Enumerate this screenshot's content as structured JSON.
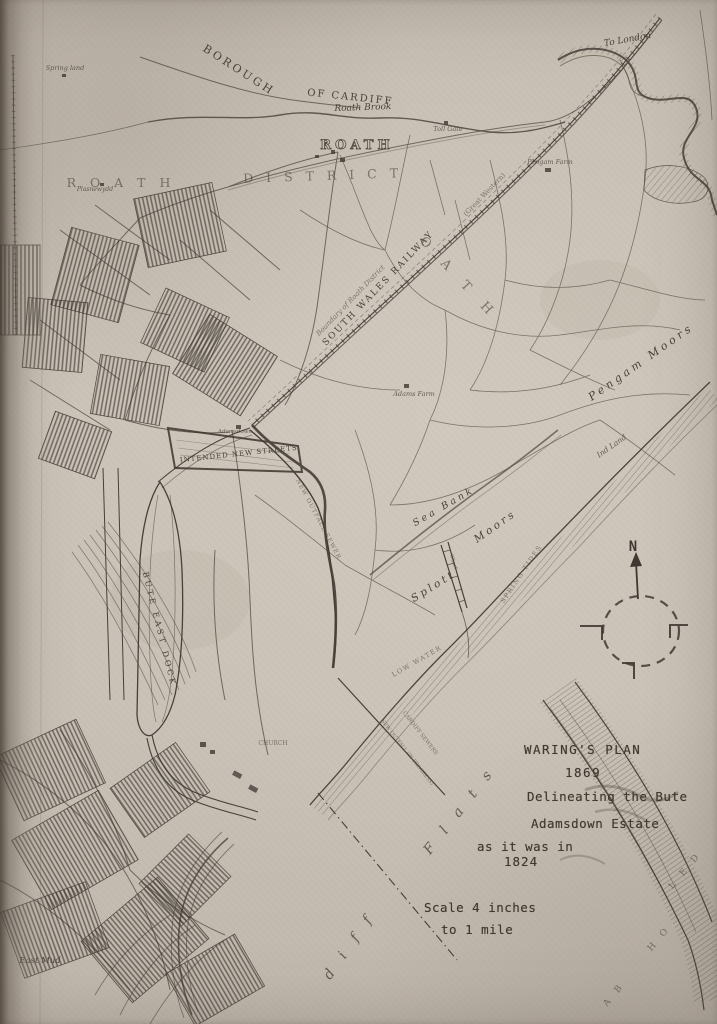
{
  "colors": {
    "paper": "#c9c0b5",
    "ink": "#4a433b",
    "gutter_shadow": "#6f665c"
  },
  "annotation": {
    "title_lines": [
      "WARING'S PLAN",
      "1869",
      "Delineating the Bute",
      "Adamsdown Estate",
      "as it was in",
      "1824"
    ],
    "scale_lines": [
      "Scale 4 inches",
      "to 1 mile"
    ]
  },
  "compass": {
    "north": "N"
  },
  "map": {
    "labels": [
      {
        "id": "to-london-label",
        "text": "To London",
        "x": 628,
        "y": 42,
        "r": -10,
        "fs": 9,
        "cls": "hand"
      },
      {
        "id": "borough-label",
        "text": "BOROUGH",
        "x": 237,
        "y": 73,
        "r": 33,
        "fs": 11,
        "ls": 3,
        "cls": "caps"
      },
      {
        "id": "of-cardiff-label",
        "text": "OF CARDIFF",
        "x": 350,
        "y": 100,
        "r": 6,
        "fs": 10,
        "ls": 2,
        "cls": "caps"
      },
      {
        "id": "roath-brook-label",
        "text": "Roath Brook",
        "x": 363,
        "y": 110,
        "r": -2,
        "fs": 9,
        "cls": "hand"
      },
      {
        "id": "roath-village-label",
        "text": "ROATH",
        "x": 357,
        "y": 149,
        "fs": 13,
        "cls": "outline"
      },
      {
        "id": "toll-gate-label",
        "text": "Toll Gate",
        "x": 448,
        "y": 131,
        "fs": 6.5,
        "cls": "hand tiny"
      },
      {
        "id": "pengam-farm-label",
        "text": "Pengam Farm",
        "x": 550,
        "y": 164,
        "fs": 6.5,
        "cls": "hand tiny"
      },
      {
        "id": "roath-spread-label",
        "text": "R O A T H",
        "x": 121,
        "y": 187,
        "fs": 12.5,
        "ls": 5,
        "cls": "caps faint"
      },
      {
        "id": "district-spread-label",
        "text": "D I S T R I C T",
        "x": 323,
        "y": 180,
        "r": -2,
        "fs": 12.5,
        "ls": 4.5,
        "cls": "caps faint"
      },
      {
        "id": "south-wales-railway-label",
        "text": "SOUTH WALES RAILWAY",
        "x": 380,
        "y": 290,
        "r": -46,
        "fs": 9,
        "ls": 2,
        "cls": "caps"
      },
      {
        "id": "great-western-label",
        "text": "(Great Western)",
        "x": 486,
        "y": 196,
        "r": -46,
        "fs": 7,
        "cls": "caps faint"
      },
      {
        "id": "boundary-of-roath-label",
        "text": "Boundary of Roath District",
        "x": 352,
        "y": 302,
        "r": -46,
        "fs": 7,
        "cls": "hand faint"
      },
      {
        "id": "oath-spread-label",
        "text": "O A T H",
        "x": 456,
        "y": 281,
        "r": 47,
        "fs": 13,
        "ls": 8,
        "cls": "caps faint"
      },
      {
        "id": "pengam-moors-label",
        "text": "Pengam Moors",
        "x": 643,
        "y": 365,
        "r": -35,
        "fs": 11,
        "ls": 3.5,
        "cls": "hand"
      },
      {
        "id": "adams-farm-label",
        "text": "Adams Farm",
        "x": 414,
        "y": 396,
        "fs": 6.5,
        "cls": "hand tiny"
      },
      {
        "id": "ind-land-label",
        "text": "Ind Land",
        "x": 613,
        "y": 448,
        "r": -35,
        "fs": 7.5,
        "cls": "hand tiny"
      },
      {
        "id": "sea-bank-label",
        "text": "Sea Bank",
        "x": 445,
        "y": 509,
        "r": -30,
        "fs": 9.5,
        "ls": 3,
        "cls": "hand"
      },
      {
        "id": "moors-label",
        "text": "Moors",
        "x": 497,
        "y": 529,
        "r": -35,
        "fs": 10.5,
        "ls": 3,
        "cls": "hand"
      },
      {
        "id": "splott-label",
        "text": "Splott",
        "x": 435,
        "y": 589,
        "r": -32,
        "fs": 10.5,
        "ls": 3,
        "cls": "hand"
      },
      {
        "id": "spring-tides-label",
        "text": "SPRING TIDES",
        "x": 523,
        "y": 575,
        "r": -56,
        "fs": 6.5,
        "ls": 1.5,
        "cls": "caps faint"
      },
      {
        "id": "wharf-label",
        "text": "Wharf",
        "x": 452,
        "y": 562,
        "r": 72,
        "fs": 5,
        "cls": "caps faint",
        "o": 0.7
      },
      {
        "id": "low-water-label",
        "text": "LOW WATER",
        "x": 418,
        "y": 663,
        "r": -30,
        "fs": 6.5,
        "ls": 1.5,
        "cls": "caps faint"
      },
      {
        "id": "cardiff-sewers-label",
        "text": "CARDIFF SEWERS",
        "x": 419,
        "y": 734,
        "r": 52,
        "fs": 5.5,
        "cls": "caps faint"
      },
      {
        "id": "new-outfall-label",
        "text": "NEW OUTFALL (IN PROGRESS)",
        "x": 406,
        "y": 753,
        "r": 52,
        "fs": 5,
        "cls": "caps faint"
      },
      {
        "id": "church-label",
        "text": "CHURCH",
        "x": 273,
        "y": 745,
        "fs": 6,
        "cls": "caps faint",
        "o": 0.55
      },
      {
        "id": "intended-new-streets-label",
        "text": "INTENDED NEW STREETS",
        "x": 239,
        "y": 456,
        "r": -6,
        "fs": 7,
        "ls": 1,
        "cls": "caps"
      },
      {
        "id": "adamsdown-label",
        "text": "Adamsdown",
        "x": 235,
        "y": 433,
        "fs": 5.5,
        "cls": "hand tiny",
        "o": 0.7
      },
      {
        "id": "new-outfall-sewer-label",
        "text": "NEW OUTFALL SEWER",
        "x": 317,
        "y": 520,
        "r": 62,
        "fs": 6,
        "ls": 1,
        "cls": "caps faint"
      },
      {
        "id": "bute-east-dock-label",
        "text": "BUTE EAST DOCK",
        "x": 157,
        "y": 630,
        "r": 76,
        "fs": 8,
        "ls": 3,
        "cls": "caps"
      },
      {
        "id": "east-mud-label",
        "text": "East Mud",
        "x": 40,
        "y": 963,
        "fs": 8.5,
        "cls": "hand"
      },
      {
        "id": "flats-spread-label",
        "text": "F l a t s",
        "x": 463,
        "y": 813,
        "r": -52,
        "fs": 14,
        "ls": 6,
        "cls": "hand big"
      },
      {
        "id": "diff-spread-label",
        "text": "d i f f",
        "x": 353,
        "y": 948,
        "r": -55,
        "fs": 14,
        "ls": 6,
        "cls": "hand big"
      },
      {
        "id": "shore-letters-led",
        "text": "L E D",
        "x": 687,
        "y": 872,
        "r": -50,
        "fs": 9,
        "ls": 4,
        "cls": "caps faint"
      },
      {
        "id": "shore-letters-ho",
        "text": "H O",
        "x": 661,
        "y": 940,
        "r": -50,
        "fs": 9,
        "ls": 4,
        "cls": "caps faint"
      },
      {
        "id": "shore-letters-ab",
        "text": "A B",
        "x": 616,
        "y": 996,
        "r": -50,
        "fs": 9,
        "ls": 4,
        "cls": "caps faint"
      },
      {
        "id": "plasnewydd-label",
        "text": "Plasnewydd",
        "x": 95,
        "y": 191,
        "fs": 6,
        "cls": "hand tiny",
        "o": 0.75
      },
      {
        "id": "spring-land-label",
        "text": "Spring land",
        "x": 65,
        "y": 70,
        "fs": 6.5,
        "cls": "hand tiny",
        "o": 0.8
      }
    ]
  }
}
